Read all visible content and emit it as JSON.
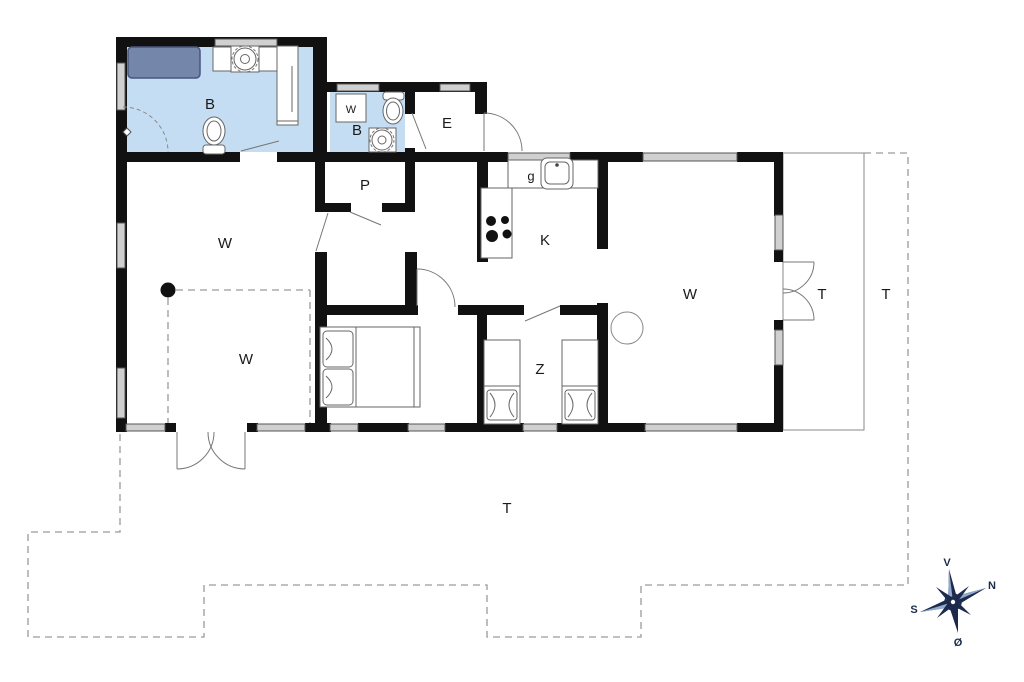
{
  "plan": {
    "room_labels": {
      "bath_main": "B",
      "bath_small": "B",
      "washing_machine": "W",
      "entrance": "E",
      "storage": "P",
      "gas_label": "g",
      "kitchen": "K",
      "living_main": "W",
      "living_annex": "W",
      "living_right": "W",
      "bedroom_children": "Z",
      "terrace_covered": "T",
      "terrace_open": "T",
      "terrace_south": "T"
    },
    "compass": {
      "west": "V",
      "north": "N",
      "south": "S",
      "east": "Ø"
    },
    "colors": {
      "wall": "#111111",
      "bath_floor": "#c5ddf3",
      "shower_mat": "#7487aa",
      "shower_mat_border": "#4a5580",
      "window_fill": "#d0d0d0",
      "outline": "#666666",
      "dashed": "#9a9a9a",
      "compass_navy": "#1c2b4d",
      "compass_light": "#93a9cc",
      "label": "#1a1a1a"
    },
    "icons": [
      "toilet-icon",
      "washbasin-icon",
      "washing-machine-icon",
      "kitchen-sink-icon",
      "stove-burners-icon",
      "double-bed-icon",
      "single-bed-icon",
      "wood-stove-icon",
      "compass-rose-icon",
      "shower-mat-icon"
    ]
  }
}
